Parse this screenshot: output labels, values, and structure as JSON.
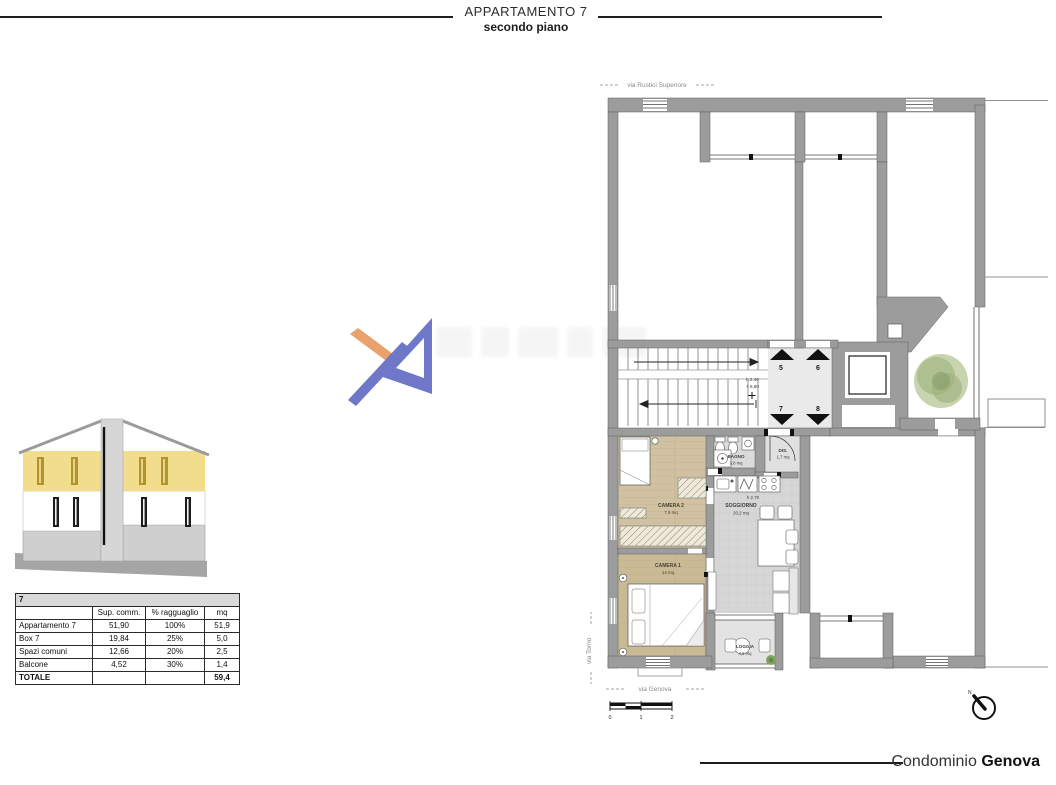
{
  "header": {
    "title": "APPARTAMENTO 7",
    "subtitle": "secondo piano"
  },
  "area_table": {
    "unit": "7",
    "columns": {
      "c0": "",
      "c1": "Sup. comm.",
      "c2": "% ragguaglio",
      "c3": "mq"
    },
    "rows": {
      "r0": {
        "label": "Appartamento 7",
        "sup": "51,90",
        "perc": "100%",
        "mq": "51,9"
      },
      "r1": {
        "label": "Box 7",
        "sup": "19,84",
        "perc": "25%",
        "mq": "5,0"
      },
      "r2": {
        "label": "Spazi comuni",
        "sup": "12,66",
        "perc": "20%",
        "mq": "2,5"
      },
      "r3": {
        "label": "Balcone",
        "sup": "4,52",
        "perc": "30%",
        "mq": "1,4"
      }
    },
    "total": {
      "label": "TOTALE",
      "mq": "59,4"
    }
  },
  "plan": {
    "streets": {
      "top": "via Rustici Superiore",
      "left": "via Torno",
      "bottom": "via Genova"
    },
    "units": {
      "u5": "5",
      "u6": "6",
      "u7": "7",
      "u8": "8"
    },
    "landing": {
      "height": "h 2.40",
      "level": "+ 6,80"
    },
    "rooms": {
      "camera2": {
        "name": "CAMERA 2",
        "area": "7,9 mq"
      },
      "camera1": {
        "name": "CAMERA 1",
        "area": "14 mq"
      },
      "bagno": {
        "name": "BAGNO",
        "area": "3,8 mq"
      },
      "dis": {
        "name": "DIS.",
        "area": "1,7 mq"
      },
      "soggiorno": {
        "name": "SOGGIORNO",
        "area": "20,2 mq",
        "height": "h 2.70"
      },
      "loggia": {
        "name": "LOGGIA",
        "area": "4,5 mq"
      }
    },
    "scale": {
      "t0": "0",
      "t1": "1",
      "t2": "2"
    },
    "compass": {
      "north": "N"
    }
  },
  "footer": {
    "label": "Condominio",
    "name": "Genova"
  },
  "colors": {
    "wall": "#9c9c9c",
    "wood": "#cfc1a1",
    "wood_dark": "#c9b995",
    "tile": "#d6d6d6",
    "landing": "#eaeaea",
    "highlight_yellow": "#f2dd8d",
    "logo_blue": "#6e77c8",
    "logo_orange": "#e9a26b",
    "tree_green": "#a9bb88"
  }
}
